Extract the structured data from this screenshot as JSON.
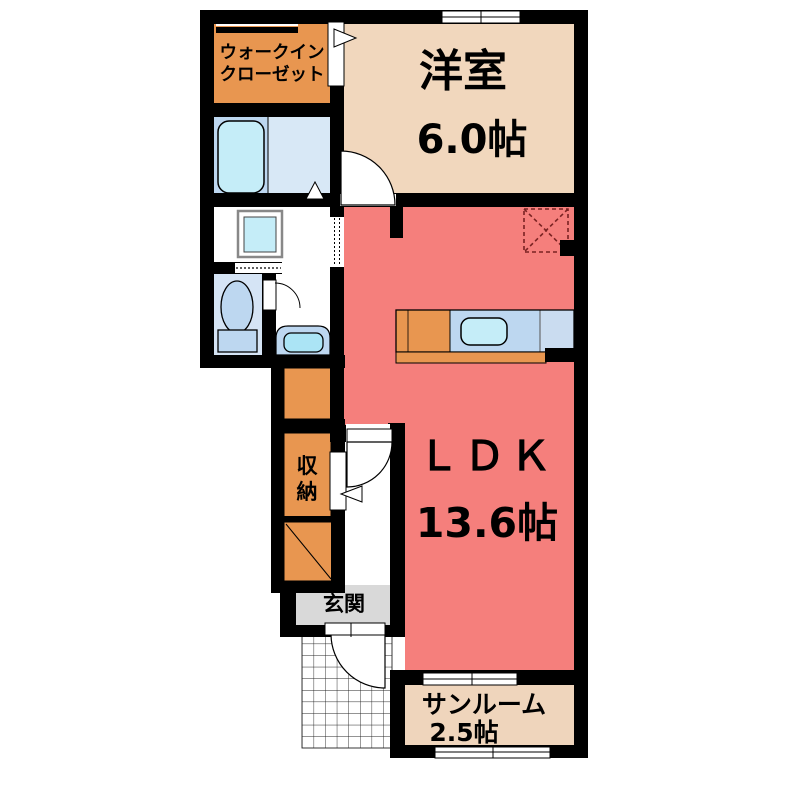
{
  "plan": {
    "type": "apartment-floor-plan",
    "rooms": {
      "walk_in_closet": {
        "label_line1": "ウォークイン",
        "label_line2": "クローゼット"
      },
      "western_room": {
        "name": "洋室",
        "size": "6.0帖"
      },
      "ldk": {
        "name": "ＬＤＫ",
        "size": "13.6帖"
      },
      "sunroom": {
        "name": "サンルーム",
        "size": "2.5帖"
      },
      "storage": {
        "chars": [
          "収",
          "納"
        ]
      },
      "entrance": {
        "name": "玄関"
      }
    },
    "colors": {
      "wall": "#000000",
      "closet_orange": "#E89650",
      "western_beige": "#F1D7BD",
      "ldk_red": "#F57F7C",
      "sunroom_beige": "#EFD5BC",
      "entrance_gray": "#D9D9D9",
      "water_blue": "#BDD7F0",
      "fixture_cyan": "#C5EDF8",
      "bath_floor_blue": "#D8E8F6",
      "toilet_floor_blue": "#D5E4F5",
      "basin_cyan": "#ABE4F5",
      "counter_blue_right": "#CADCF0",
      "fridge_dash_red": "#7A2222"
    },
    "fixtures": [
      "bathtub",
      "washing-machine",
      "toilet",
      "washbasin",
      "kitchen-counter",
      "sink",
      "refrigerator-space",
      "entrance-porch-grid"
    ]
  }
}
